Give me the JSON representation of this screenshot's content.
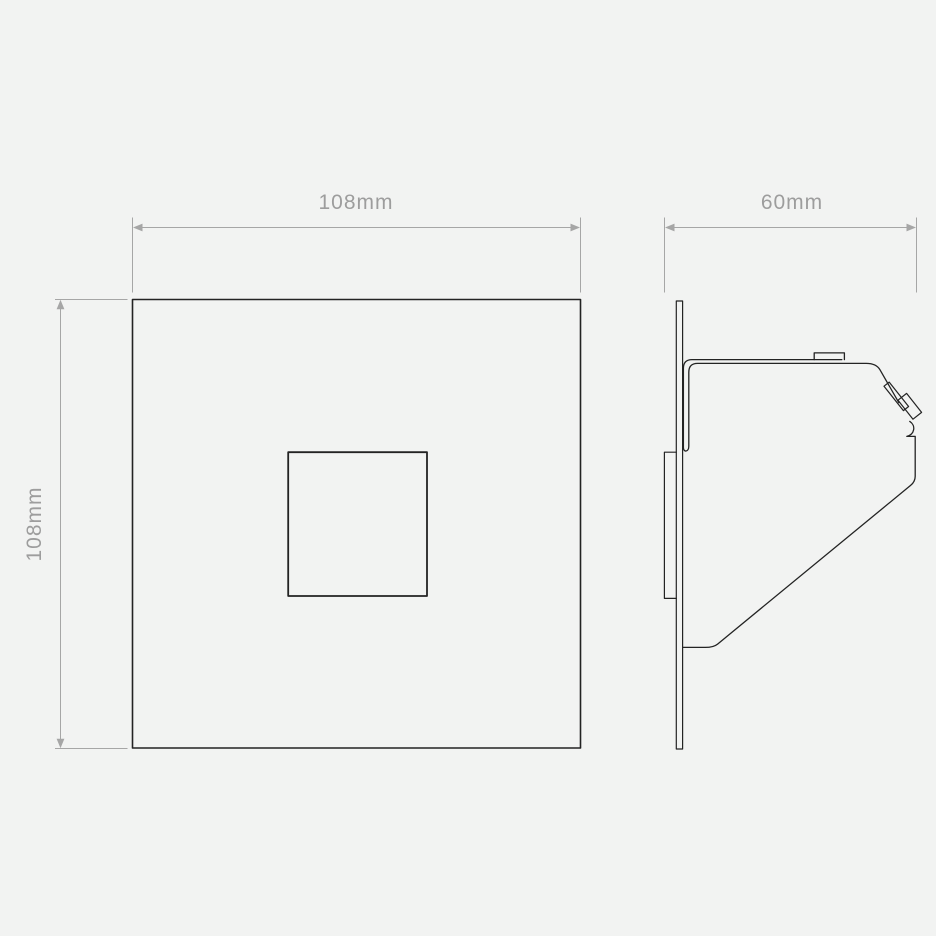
{
  "drawing": {
    "colors": {
      "background": "#f2f3f2",
      "part_line": "#232323",
      "dimension_line": "#a6a6a6",
      "label_text": "#9d9d9d",
      "aperture_fill": "#fdfdfd"
    },
    "front_view": {
      "width_label": "108mm",
      "height_label": "108mm"
    },
    "side_view": {
      "depth_label": "60mm"
    }
  }
}
